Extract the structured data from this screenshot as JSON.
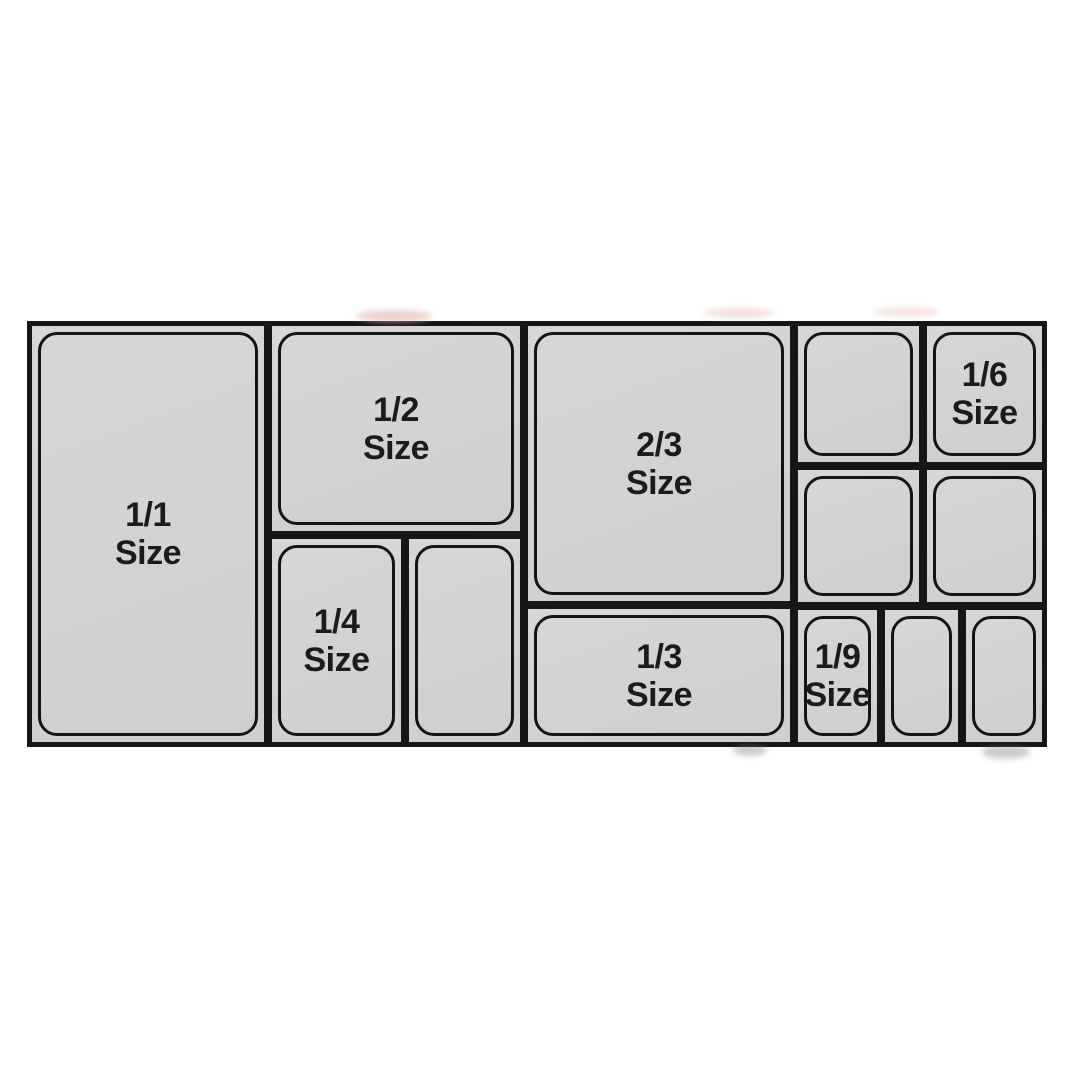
{
  "diagram": {
    "colors": {
      "pan_fill": "#d3d3d3",
      "line": "#1a1a1a",
      "label_text": "#1b1b1b",
      "background": "#ffffff"
    },
    "pans": [
      {
        "id": "1-1",
        "label": "1/1\nSize"
      },
      {
        "id": "1-2",
        "label": "1/2\nSize"
      },
      {
        "id": "1-4",
        "label": "1/4\nSize"
      },
      {
        "id": "1-4-unlabeled",
        "label": ""
      },
      {
        "id": "2-3",
        "label": "2/3\nSize"
      },
      {
        "id": "1-3",
        "label": "1/3\nSize"
      },
      {
        "id": "1-6-unlabeled-a",
        "label": ""
      },
      {
        "id": "1-6",
        "label": "1/6\nSize"
      },
      {
        "id": "1-6-unlabeled-b",
        "label": ""
      },
      {
        "id": "1-6-unlabeled-c",
        "label": ""
      },
      {
        "id": "1-9",
        "label": "1/9\nSize"
      },
      {
        "id": "1-9-unlabeled-a",
        "label": ""
      },
      {
        "id": "1-9-unlabeled-b",
        "label": ""
      }
    ]
  }
}
